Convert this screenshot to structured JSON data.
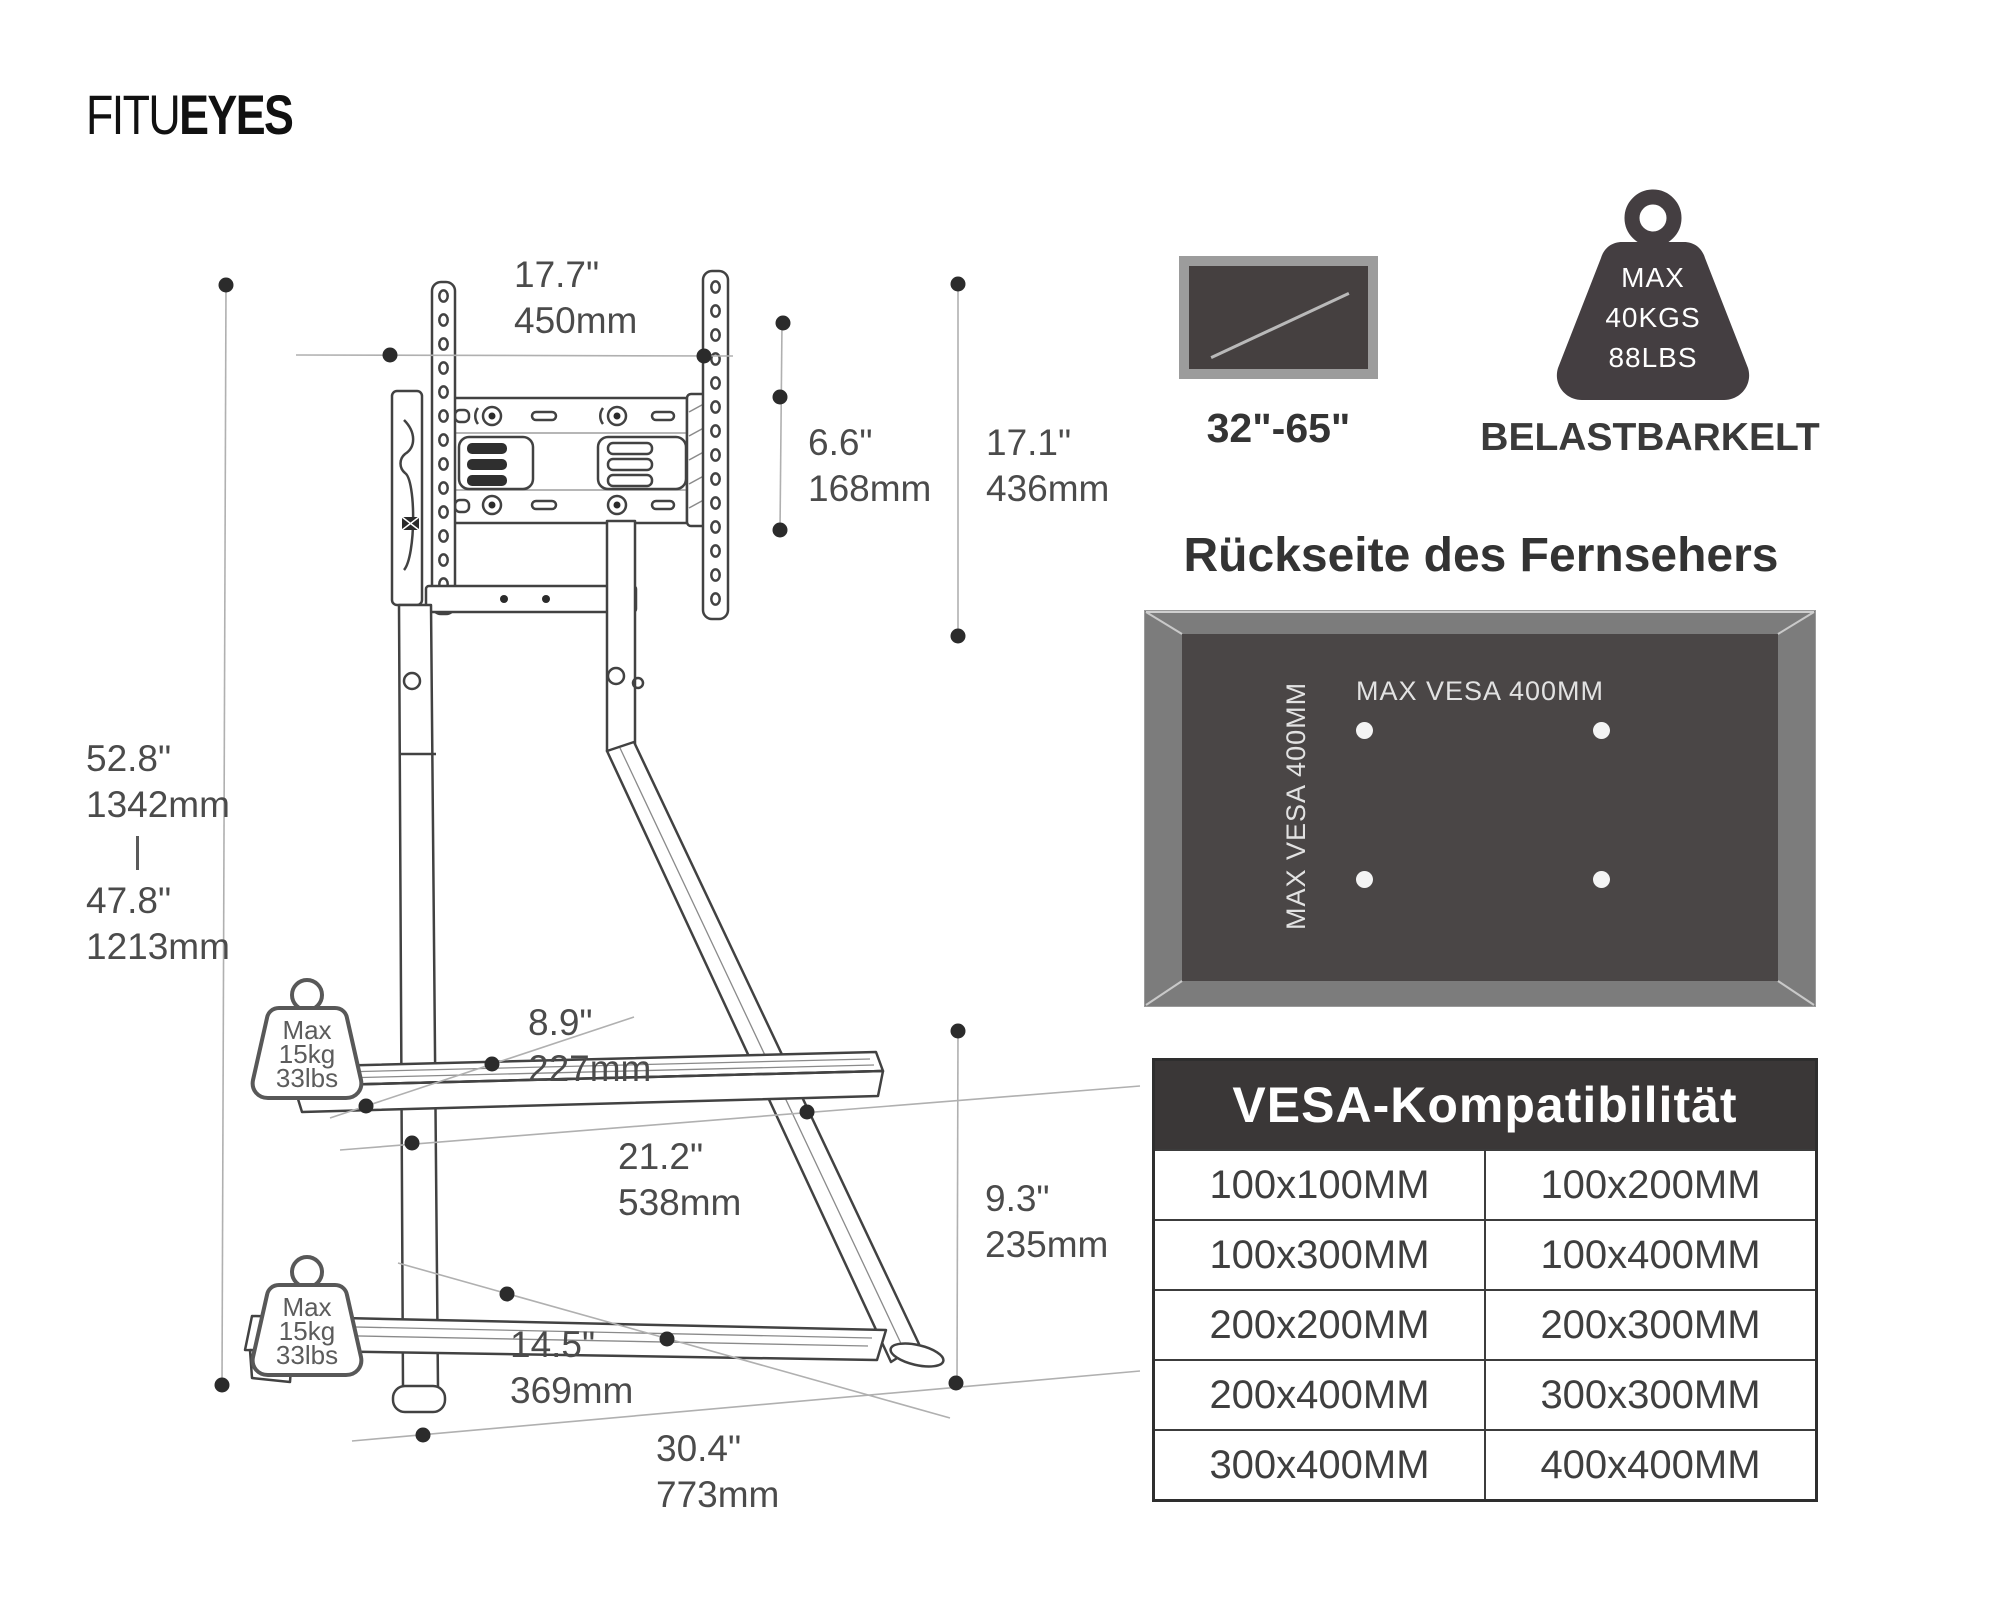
{
  "logo": {
    "part1": "FITU",
    "part2": "EYES"
  },
  "dimensions": {
    "top_width": {
      "inches": "17.7\"",
      "mm": "450mm"
    },
    "bracket_height": {
      "inches": "6.6\"",
      "mm": "168mm"
    },
    "mount_height": {
      "inches": "17.1\"",
      "mm": "436mm"
    },
    "height_max": {
      "inches": "52.8\"",
      "mm": "1342mm"
    },
    "height_min": {
      "inches": "47.8\"",
      "mm": "1213mm"
    },
    "shelf_depth": {
      "inches": "8.9\"",
      "mm": "227mm"
    },
    "shelf_width": {
      "inches": "21.2\"",
      "mm": "538mm"
    },
    "bottom_height": {
      "inches": "9.3\"",
      "mm": "235mm"
    },
    "base_shelf_depth": {
      "inches": "14.5\"",
      "mm": "369mm"
    },
    "base_width": {
      "inches": "30.4\"",
      "mm": "773mm"
    }
  },
  "shelf_load": {
    "line1": "Max",
    "line2": "15kg",
    "line3": "33lbs"
  },
  "screen_range": "32\"-65\"",
  "max_load": {
    "line1": "MAX",
    "line2": "40KGS",
    "line3": "88LBS"
  },
  "capacity_label": "BELASTBARKELT",
  "back_panel": {
    "heading": "Rückseite des Fernsehers",
    "vesa_horizontal": "MAX VESA 400MM",
    "vesa_vertical": "MAX VESA 400MM"
  },
  "vesa_table": {
    "title": "VESA-Kompatibilität",
    "rows": [
      [
        "100x100MM",
        "100x200MM"
      ],
      [
        "100x300MM",
        "100x400MM"
      ],
      [
        "200x200MM",
        "200x300MM"
      ],
      [
        "200x400MM",
        "300x300MM"
      ],
      [
        "300x400MM",
        "400x400MM"
      ]
    ]
  },
  "colors": {
    "accent_dark": "#3a3737",
    "panel_outer": "#7c7c7c",
    "panel_inner": "#4a4646",
    "line_art": "#424242"
  }
}
